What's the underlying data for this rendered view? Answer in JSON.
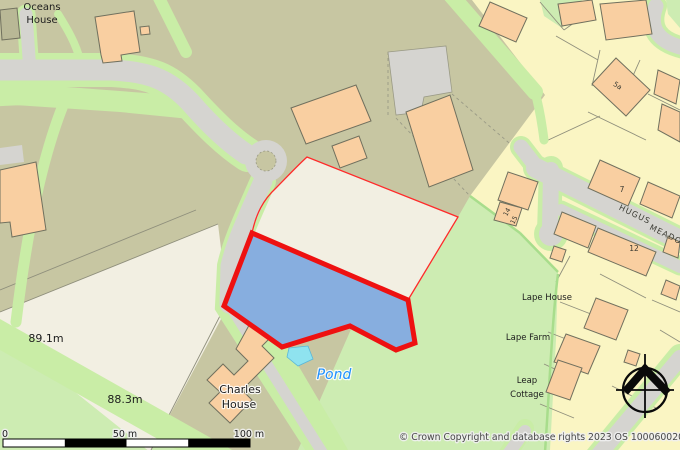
{
  "map": {
    "attribution": "© Crown Copyright and database rights 2023 OS 100060020",
    "labels": {
      "oceans1": "Oceans",
      "oceans2": "House",
      "spot1": "89.1m",
      "spot2": "88.3m",
      "charles1": "Charles",
      "charles2": "House",
      "pond": "Pond",
      "lape_house": "Lape House",
      "lape_farm": "Lape Farm",
      "leap1": "Leap",
      "leap2": "Cottage",
      "street1": "HUGUS",
      "street2": "MEADOW",
      "num_5a": "5a",
      "num_7": "7",
      "num_12": "12",
      "num_14": "14",
      "num_15": "15"
    },
    "scale_bar": {
      "zero": "0",
      "mid": "50 m",
      "end": "100 m"
    },
    "colors": {
      "parcel_fill": "#87aedf",
      "parcel_border": "#ee1111",
      "site_outline": "#ff2a2a",
      "pond_fill": "#8fe3ef",
      "pond_label": "#1e90ff",
      "field_green": "#cdecb2",
      "scrub_olive": "#c7c6a2",
      "residential_yellow": "#faf5c3",
      "plot_cream": "#f2efe2",
      "road_gray": "#d5d4d0",
      "building_peach": "#f9cfa1"
    }
  }
}
